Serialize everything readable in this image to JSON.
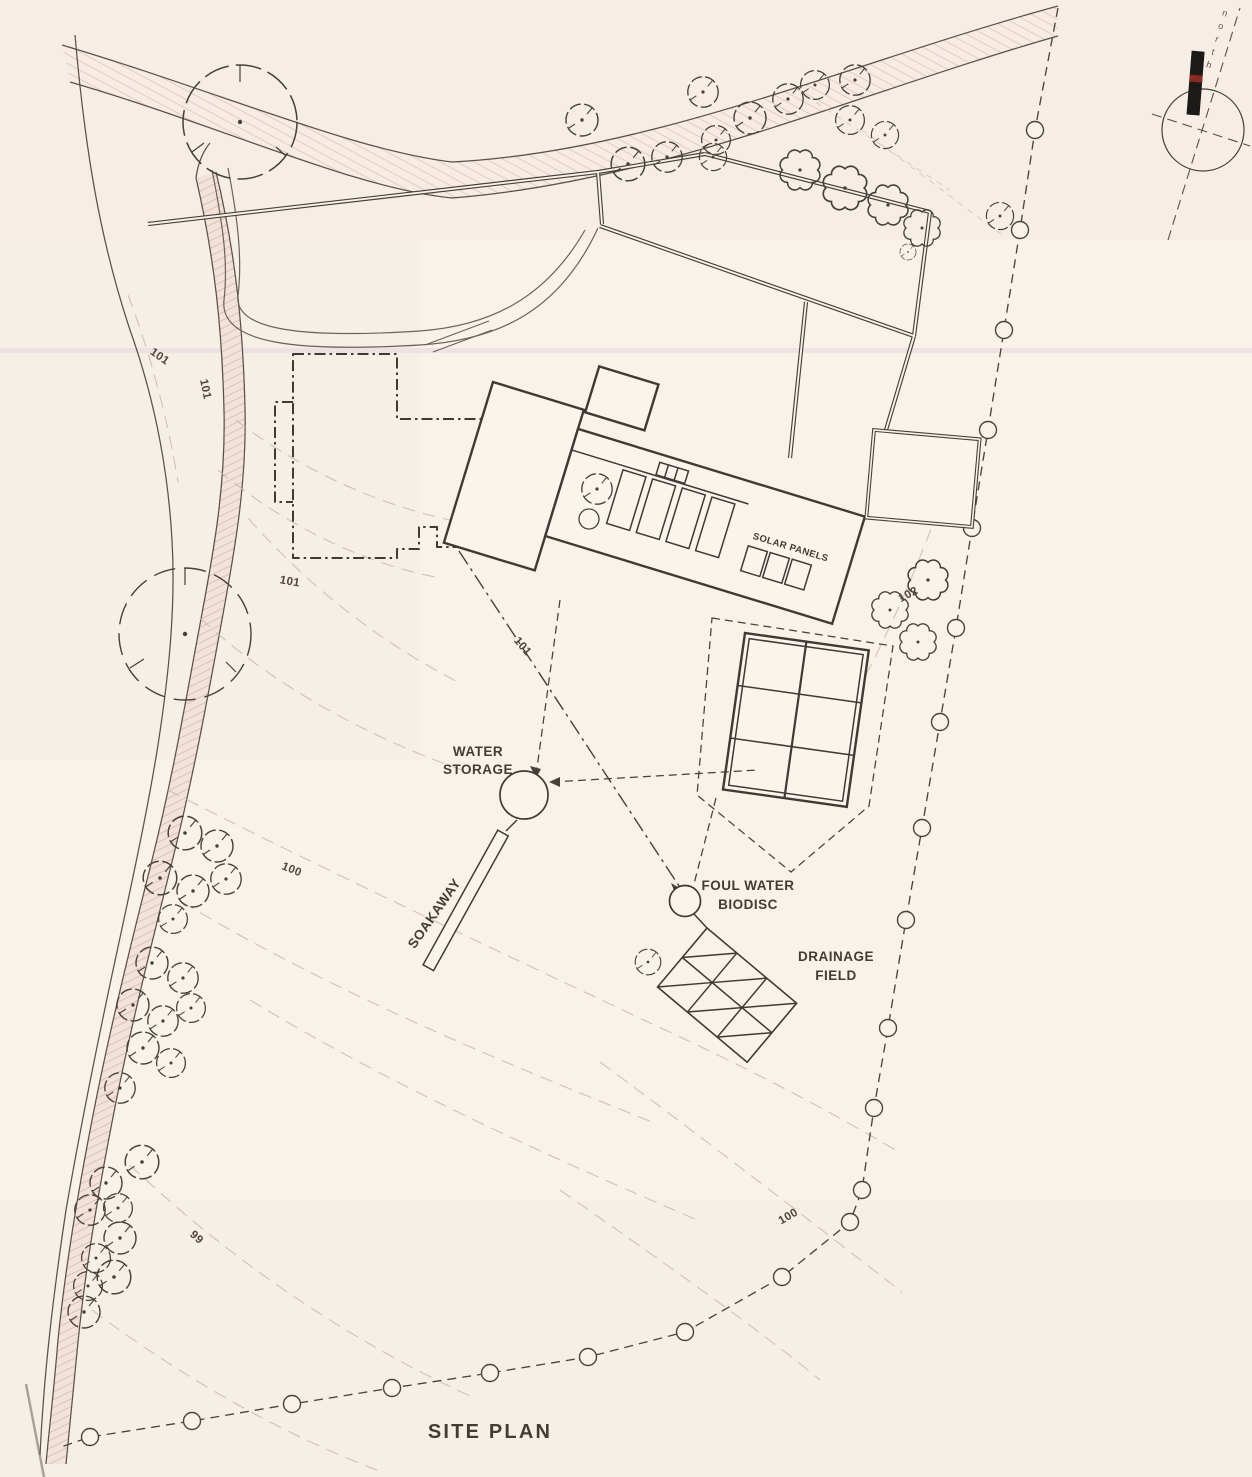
{
  "title": "SITE PLAN",
  "colors": {
    "paper": "#f8f2e9",
    "ink": "#46403a",
    "contour": "#c9b8a8",
    "stream_fill": "#f2e2d9",
    "stream_hatch": "#d9b9ab",
    "road_fill": "#f7ece3",
    "north_bar": "#1c1a18",
    "north_bar_red": "#8b2a20",
    "scan_line": "#e8d5e6"
  },
  "north_arrow": {
    "label": "north"
  },
  "annotations": {
    "solar_panels": "SOLAR PANELS",
    "water_storage": [
      "WATER",
      "STORAGE"
    ],
    "soakaway": "SOAKAWAY",
    "foul_water_biodisc": [
      "FOUL WATER",
      "BIODISC"
    ],
    "drainage_field": [
      "DRAINAGE",
      "FIELD"
    ]
  },
  "contour_labels": [
    "101",
    "101",
    "101",
    "101",
    "102",
    "100",
    "100",
    "99"
  ]
}
